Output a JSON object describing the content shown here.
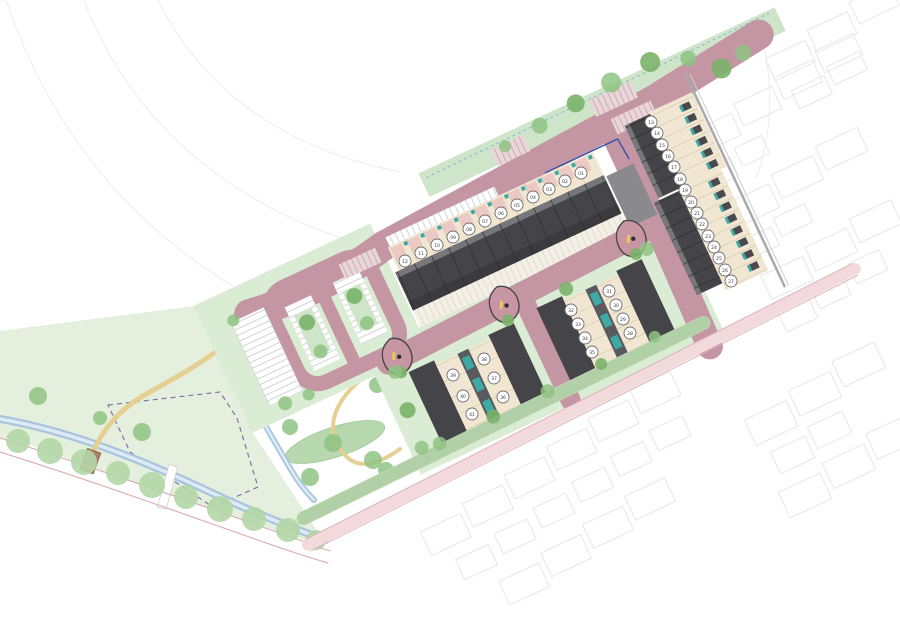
{
  "plan": {
    "plots": [
      "01",
      "02",
      "03",
      "04",
      "05",
      "06",
      "07",
      "08",
      "09",
      "10",
      "11",
      "12",
      "13",
      "14",
      "15",
      "16",
      "17",
      "18",
      "19",
      "20",
      "21",
      "22",
      "23",
      "24",
      "25",
      "26",
      "27",
      "28",
      "29",
      "30",
      "31",
      "32",
      "33",
      "34",
      "35",
      "36",
      "37",
      "38",
      "39",
      "40",
      "41"
    ],
    "palette": {
      "road_pink": "#c495a2",
      "building_dark": "#454549",
      "building_light": "#8a8a8e",
      "garden_cream": "#f1e6d1",
      "drive_salmon": "#ecc9c3",
      "store_teal": "#3fa9a4",
      "green_space": "#daecd3",
      "park_green": "#e4f0dd",
      "hedge_green": "#c3dcba",
      "tree_green": "#8fc383",
      "stream_blue": "#a9c4dc",
      "path_yellow": "#e5cf92",
      "footpath_pink": "#cfa8b2",
      "existing_road_pink": "#f2d9dc",
      "boundary_dash_purple": "#7d74a8",
      "site_boundary_blue": "#2f4fae",
      "context_gray": "#e7e7eb"
    }
  }
}
